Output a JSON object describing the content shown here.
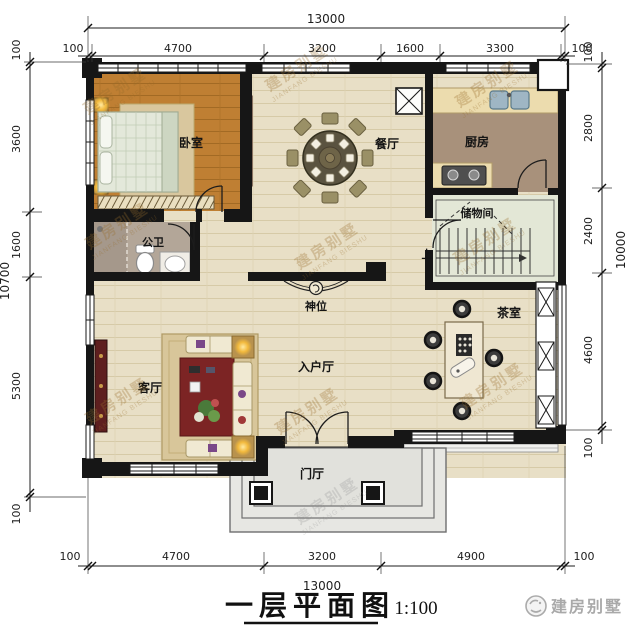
{
  "plan": {
    "title": "一层平面图",
    "scale": "1:100",
    "brand": "建房别墅",
    "watermark_cn": "建房别墅",
    "watermark_en": "JIANFANG BIESHU"
  },
  "rooms": {
    "bedroom": "卧室",
    "dining_room": "餐厅",
    "kitchen": "厨房",
    "storage_room": "储物间",
    "bathroom": "公卫",
    "shrine": "神位",
    "living_room": "客厅",
    "entry_hall": "入户厅",
    "tea_room": "茶室",
    "porch": "门厅",
    "stairs_up": "上"
  },
  "dimensions": {
    "top": {
      "total": "13000",
      "segments": [
        "100",
        "4700",
        "3200",
        "1600",
        "3300",
        "100"
      ]
    },
    "bottom": {
      "total": "13000",
      "segments": [
        "100",
        "4700",
        "3200",
        "4900",
        "100"
      ]
    },
    "left": {
      "total": "10700",
      "segments": [
        "100",
        "3600",
        "1600",
        "5300",
        "100"
      ]
    },
    "right": {
      "total": "10000",
      "segments": [
        "100",
        "2800",
        "2400",
        "4600",
        "100"
      ]
    }
  }
}
